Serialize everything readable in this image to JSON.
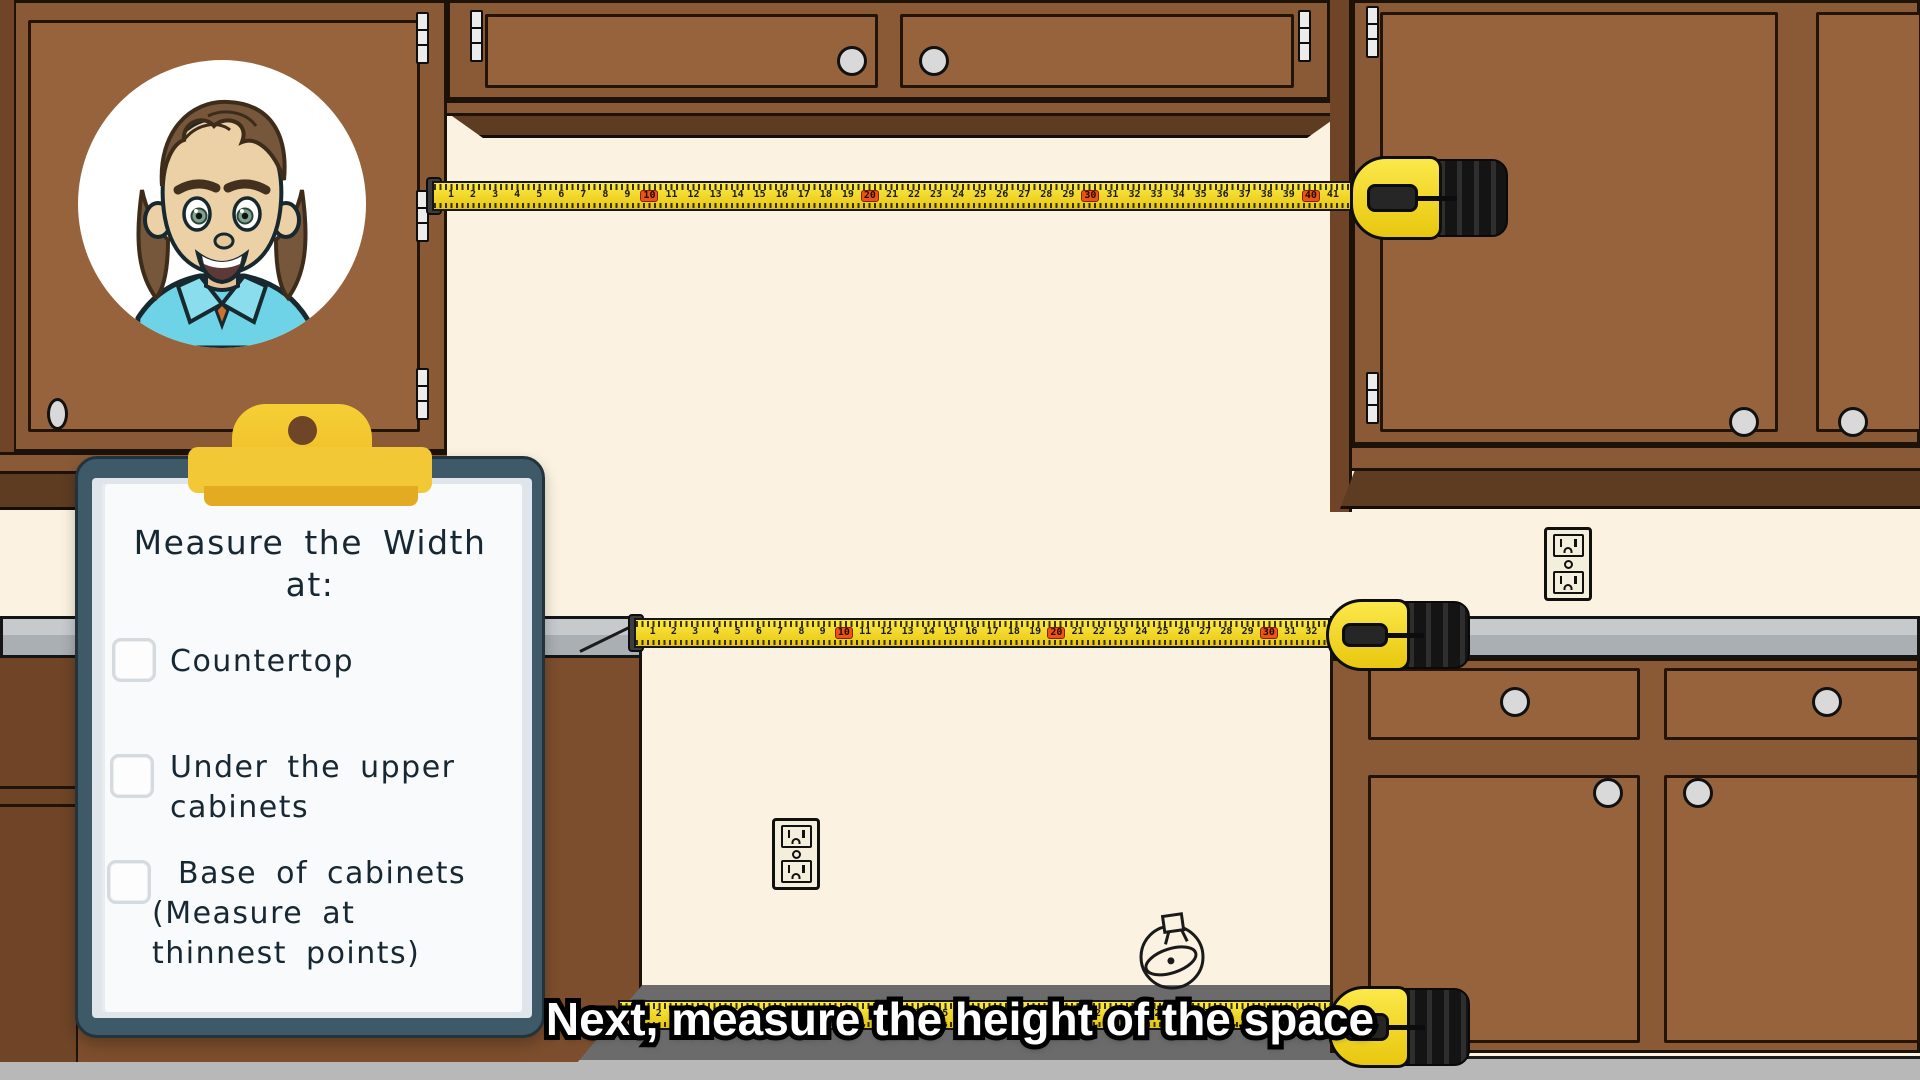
{
  "caption": {
    "text": "Next, measure the height of the space"
  },
  "clipboard": {
    "title": [
      "Measure the Width",
      "at:"
    ],
    "items": [
      {
        "lines": [
          "Countertop"
        ],
        "checked": false
      },
      {
        "lines": [
          "Under the upper",
          "cabinets"
        ],
        "checked": false
      },
      {
        "lines": [
          "Base of cabinets",
          "(Measure at",
          "thinnest points)"
        ],
        "checked": false
      }
    ]
  },
  "tapes": {
    "red_every": 10,
    "top": {
      "numbers": [
        1,
        2,
        3,
        4,
        5,
        6,
        7,
        8,
        9,
        10,
        11,
        12,
        13,
        14,
        15,
        16,
        17,
        18,
        19,
        20,
        21,
        22,
        23,
        24,
        25,
        26,
        27,
        28,
        29,
        30,
        31,
        32,
        33,
        34,
        35,
        36,
        37,
        38,
        39,
        40,
        41
      ]
    },
    "middle": {
      "numbers": [
        1,
        2,
        3,
        4,
        5,
        6,
        7,
        8,
        9,
        10,
        11,
        12,
        13,
        14,
        15,
        16,
        17,
        18,
        19,
        20,
        21,
        22,
        23,
        24,
        25,
        26,
        27,
        28,
        29,
        30,
        31,
        32
      ]
    },
    "bottom": {
      "numbers": [
        1,
        2,
        3,
        4,
        5,
        6,
        7,
        8,
        9,
        10,
        11,
        12,
        13,
        14,
        15,
        16,
        17,
        18,
        19,
        20,
        21,
        22,
        23,
        24,
        25,
        26,
        27,
        28,
        29,
        30,
        31,
        32
      ]
    }
  },
  "colors": {
    "wall": "#FBF2E1",
    "cabinet": "#8A5A37",
    "cabinet_panel": "#96633C",
    "cabinet_dark": "#5E3C22",
    "cabinet_side": "#6F4427",
    "outline": "#1D1208",
    "counter_top": "#C6CACD",
    "counter_bottom": "#A9AFB2",
    "floor": "#B8B8B8",
    "recess_shadow": "#6B6B6B",
    "tape_yellow": "#F2D71F",
    "tape_red": "#EA5414",
    "case_yellow": "#F5DB25",
    "case_black": "#1A1A1A",
    "board_teal": "#3E5A68",
    "clip_gold": "#F3C837",
    "clip_gold_dark": "#E2AB22",
    "paper": "#F8FAFC",
    "knob": "#D9D9D9",
    "hinge": "#ECECEC",
    "outlet_plate": "#F4EEDD",
    "ink": "#182832",
    "skin": "#ECD0A6",
    "hair": "#76573B",
    "shirt": "#6ED3E6"
  }
}
